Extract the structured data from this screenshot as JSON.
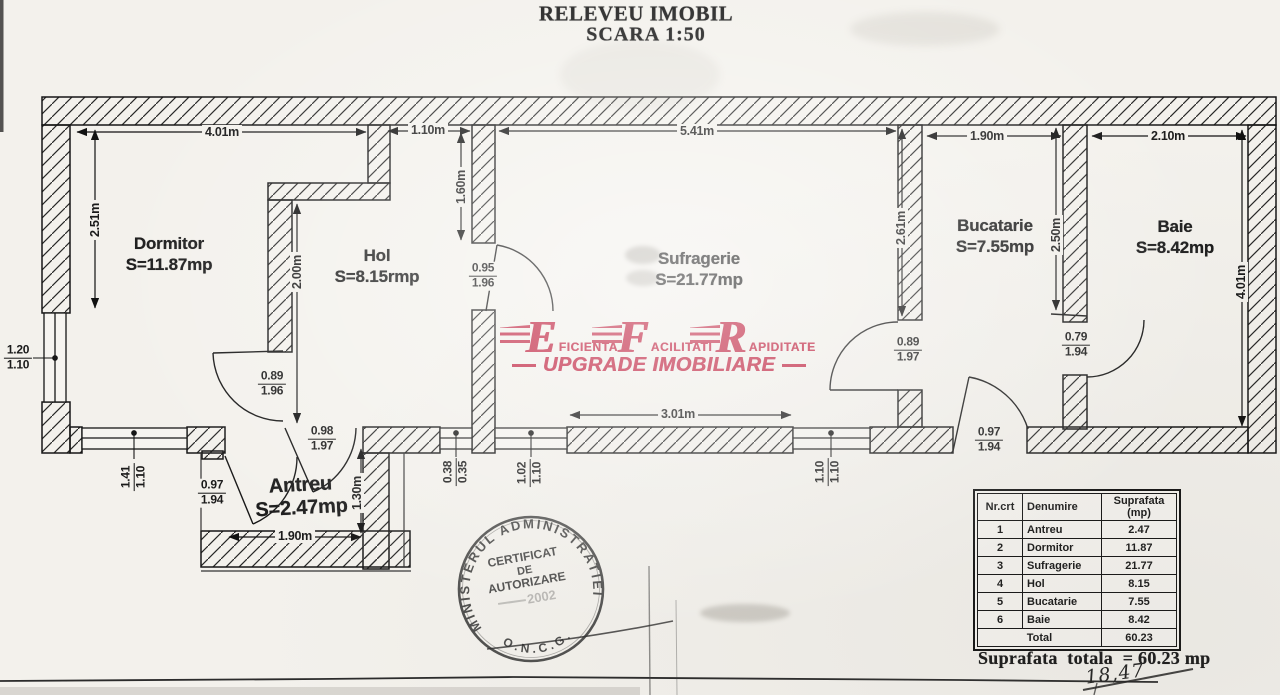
{
  "title": {
    "line1": "RELEVEU IMOBIL",
    "line2": "SCARA 1:50"
  },
  "rooms": {
    "dormitor": {
      "name": "Dormitor",
      "area": "S=11.87mp"
    },
    "hol": {
      "name": "Hol",
      "area": "S=8.15rmp"
    },
    "sufragerie": {
      "name": "Sufragerie",
      "area": "S=21.77mp"
    },
    "bucatarie": {
      "name": "Bucatarie",
      "area": "S=7.55mp"
    },
    "baie": {
      "name": "Baie",
      "area": "S=8.42mp"
    },
    "antreu": {
      "name": "Antreu",
      "area": "S=2.47mp"
    }
  },
  "dims": {
    "dormitor_width": "4.01m",
    "hol_top_width": "1.10m",
    "sufragerie_width": "5.41m",
    "bucatarie_width": "1.90m",
    "baie_width": "2.10m",
    "dormitor_height": "2.51m",
    "hol_wall": "1.60m",
    "hol_height": "2.00m",
    "sufragerie_height": "2.61m",
    "bucatarie_height": "2.50m",
    "baie_height": "4.01m",
    "sufragerie_bottom": "3.01m",
    "antreu_width": "1.90m",
    "antreu_height": "1.30m"
  },
  "openings": {
    "w_left": {
      "top": "1.20",
      "bottom": "1.10"
    },
    "w_bottom_left": {
      "top": "1.41",
      "bottom": "1.10"
    },
    "d_dormitor": {
      "top": "0.89",
      "bottom": "1.96"
    },
    "d_antreu_ext": {
      "top": "0.97",
      "bottom": "1.94"
    },
    "d_hol_antreu": {
      "top": "0.98",
      "bottom": "1.97"
    },
    "d_hol_suf": {
      "top": "0.95",
      "bottom": "1.96"
    },
    "w_038": {
      "top": "0.38",
      "bottom": "0.35"
    },
    "w_102": {
      "top": "1.02",
      "bottom": "1.10"
    },
    "w_110": {
      "top": "1.10",
      "bottom": "1.10"
    },
    "d_suf_buc": {
      "top": "0.89",
      "bottom": "1.97"
    },
    "d_baie": {
      "top": "0.79",
      "bottom": "1.94"
    },
    "d_balcon": {
      "top": "0.97",
      "bottom": "1.94"
    }
  },
  "logo": {
    "l1": "E",
    "w1": "FICIENTA",
    "l2": "F",
    "w2": "ACILITATI",
    "l3": "R",
    "w3": "APIDITATE",
    "tagline": "UPGRADE IMOBILIARE",
    "color": "#bf1f3d"
  },
  "stamp": {
    "arc_top": "MINISTERUL ADMINISTRATIEI",
    "line1": "CERTIFICAT",
    "line2": "DE",
    "line3": "AUTORIZARE",
    "line4": "2002",
    "arc_bottom": "O.N.C.G."
  },
  "table": {
    "headers": [
      "Nr.crt",
      "Denumire",
      "Suprafata (mp)"
    ],
    "rows": [
      [
        "1",
        "Antreu",
        "2.47"
      ],
      [
        "2",
        "Dormitor",
        "11.87"
      ],
      [
        "3",
        "Sufragerie",
        "21.77"
      ],
      [
        "4",
        "Hol",
        "8.15"
      ],
      [
        "5",
        "Bucatarie",
        "7.55"
      ],
      [
        "6",
        "Baie",
        "8.42"
      ]
    ],
    "total_label": "Total",
    "total_value": "60.23"
  },
  "summary": {
    "text": "Suprafata  totala  = 60.23 mp",
    "handwritten": "18,47"
  }
}
